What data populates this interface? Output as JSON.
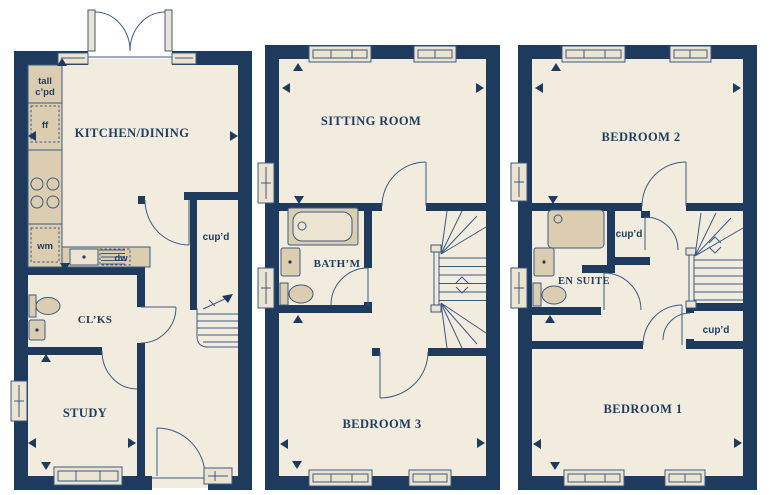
{
  "plans": {
    "ground": {
      "name": "ground-floor",
      "labels": {
        "tall_cupboard_line1": "tall",
        "tall_cupboard_line2": "c’pd",
        "fridge_freezer": "ff",
        "kitchen_dining": "KITCHEN/DINING",
        "washing_machine": "wm",
        "dishwasher": "dw",
        "cupboard": "cup’d",
        "cloakroom": "CL’KS",
        "study": "STUDY"
      }
    },
    "first": {
      "name": "first-floor",
      "labels": {
        "sitting_room": "SITTING ROOM",
        "bathroom": "BATH’M",
        "bedroom_3": "BEDROOM 3"
      }
    },
    "second": {
      "name": "second-floor",
      "labels": {
        "bedroom_2": "BEDROOM 2",
        "cupboard_upper": "cup’d",
        "en_suite": "EN SUITE",
        "cupboard_lower": "cup’d",
        "bedroom_1": "BEDROOM 1"
      }
    }
  },
  "colors": {
    "wall": "#1e3a5c",
    "floor": "#f2ecdf",
    "fixture": "#dccdb0",
    "window": "#ece4d1",
    "line": "#3b5a83",
    "text": "#1f3d60",
    "background": "#ffffff"
  }
}
